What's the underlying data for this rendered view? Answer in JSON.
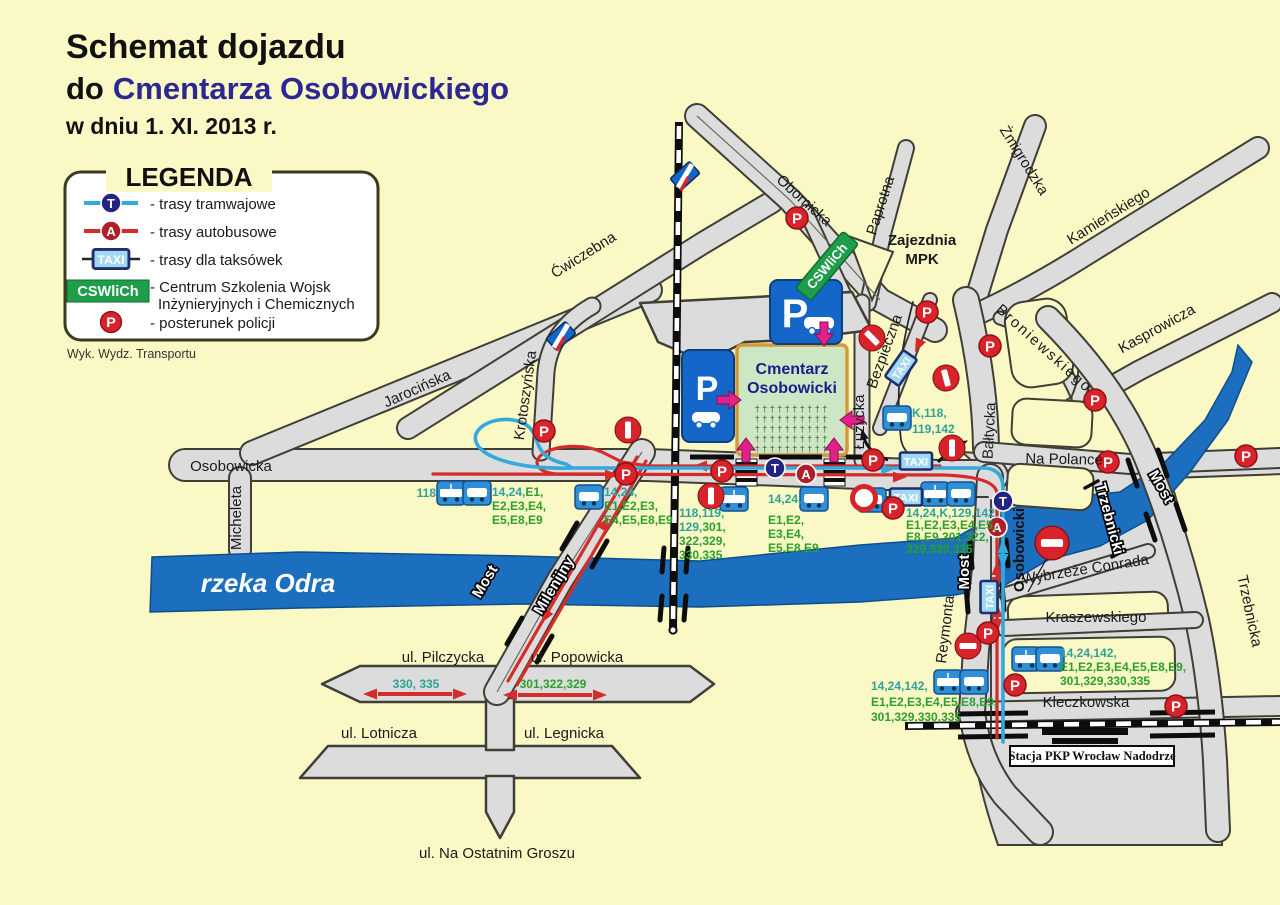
{
  "title": {
    "line1": "Schemat dojazdu",
    "line2_prefix": "do",
    "line2_main": "Cmentarza Osobowickiego",
    "line3": "w dniu 1. XI. 2013 r."
  },
  "legend": {
    "heading": "LEGENDA",
    "tram": "- trasy tramwajowe",
    "bus": "- trasy autobusowe",
    "taxi": "- trasy dla taksówek",
    "cswlich_l1": "- Centrum Szkolenia Wojsk",
    "cswlich_l2": "Inżynieryjnych i Chemicznych",
    "police": "- posterunek policji",
    "footnote": "Wyk. Wydz. Transportu"
  },
  "badges": {
    "taxi": "TAXI",
    "cswlich": "CSWliCh",
    "tram": "T",
    "bus": "A",
    "police": "P",
    "parking": "P"
  },
  "streets": {
    "obornicka": "Obornicka",
    "paprotna": "Paprotna",
    "zmigrodzka": "Żmigrodzka",
    "kamienskiego": "Kamieńskiego",
    "kasprowicza": "Kasprowicza",
    "broniewskiego": "Broniewskiego",
    "cwiczebna": "Ćwiczebna",
    "jarocinska": "Jarocińska",
    "krotoszynska": "Krotoszyńska",
    "osobowicka": "Osobowicka",
    "micheleta": "Micheleta",
    "luzycka": "Łużycka",
    "bezpieczna": "Bezpieczna",
    "baltycka": "Bałtycka",
    "na_polance": "Na Polance",
    "trzebnicka": "Trzebnicka",
    "wybrzeze_conrada": "Wybrzeże Conrada",
    "kraszewskiego": "Kraszewskiego",
    "kleczkowska": "Kleczkowska",
    "reymonta": "Reymonta",
    "pilczycka": "ul. Pilczycka",
    "popowicka": "ul. Popowicka",
    "lotnicza": "ul. Lotnicza",
    "legnicka": "ul. Legnicka",
    "na_ostatnim_groszu": "ul. Na Ostatnim Groszu"
  },
  "bridges": {
    "milenijny_most": "Most",
    "milenijny_name": "Milenijny",
    "osobowicki_most": "Most",
    "osobowicki_name": "Osobowicki",
    "trzebnicki_most": "Most",
    "trzebnicki_name": "Trzebnicki"
  },
  "places": {
    "zajezdnia_l1": "Zajezdnia",
    "zajezdnia_l2": "MPK",
    "cemetery_l1": "Cmentarz",
    "cemetery_l2": "Osobowicki",
    "river": "rzeka Odra",
    "station": "Stacja PKP Wrocław Nadodrze",
    "cross_row": "† † † † † † † † † †"
  },
  "routes": {
    "w118": "118",
    "w1": {
      "l1a": "14,24,",
      "l1b": "E1,",
      "l2": "E2,E3,E4,",
      "l3": "E5,E8,E9"
    },
    "w2": {
      "l1": "14,24,",
      "l2": "E1,E2,E3,",
      "l3": "E4,E5,E8,E9"
    },
    "center": {
      "l1": "118,119,",
      "l2a": "129,",
      "l2b": "301,",
      "l3": "322,329,",
      "l4": "330,335"
    },
    "east": {
      "l1": "14,24,",
      "l2": "E1,E2,",
      "l3": "E3,E4,",
      "l4": "E5,E8,E9"
    },
    "k118": {
      "l1": "K,118,",
      "l2": "119,142"
    },
    "bridge_north": {
      "l1": "14,24,K,129,142,",
      "l2": "E1,E2,E3,E4,E5,",
      "l3": "E8,E9,301,322,",
      "l4": "329,330,335"
    },
    "reymonta": {
      "l1": "14,24,142,",
      "l2": "E1,E2,E3,E4,E5,E8,E9,",
      "l3": "301,329,330,335"
    },
    "kleczkowska": {
      "l1": "14,24,142,",
      "l2": "E1,E2,E3,E4,E5,E8,E9,",
      "l3": "301,329,330,335"
    },
    "pilczycka": "330, 335",
    "popowicka": "301,322,329"
  },
  "colors": {
    "tram_line": "#35A8DC",
    "bus_line": "#D42B2B",
    "taxi_box": "#9FD8F0",
    "cswlich_green": "#1E9E4A",
    "police_red": "#D8232A",
    "route_teal": "#2DA396",
    "route_green": "#2CA02C",
    "river_blue": "#1B6FBE",
    "cemetery_green": "#CDE6C3",
    "parking_blue": "#1467C8",
    "title_navy": "#2B2894"
  }
}
